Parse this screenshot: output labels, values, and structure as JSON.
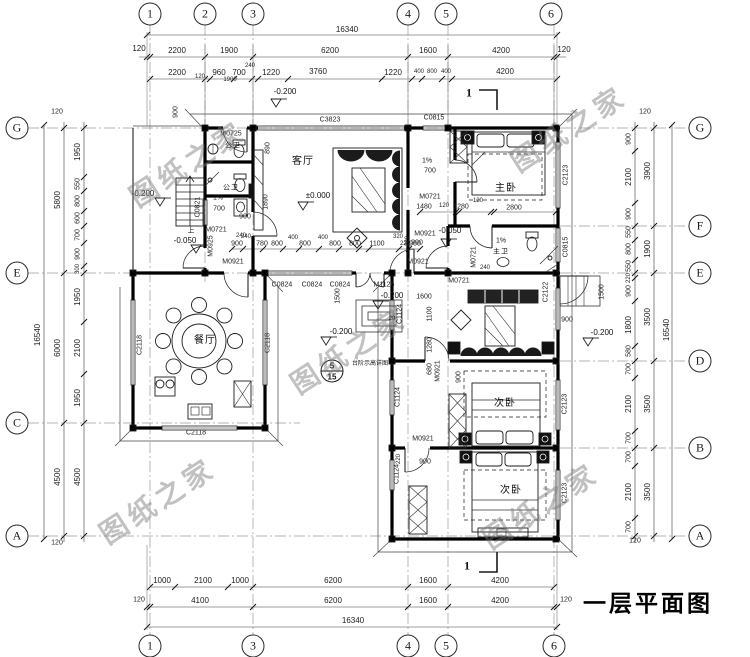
{
  "title": "一层平面图",
  "watermarks": {
    "text": "图纸之家",
    "positions": [
      {
        "x": 187,
        "y": 163
      },
      {
        "x": 568,
        "y": 128
      },
      {
        "x": 348,
        "y": 350
      },
      {
        "x": 540,
        "y": 505
      },
      {
        "x": 157,
        "y": 500
      }
    ]
  },
  "section": {
    "label": "1"
  },
  "detail_ref": {
    "num": "5",
    "sheet": "15",
    "note": "台阶示高详图"
  },
  "axis_markers": {
    "top": [
      {
        "label": "1",
        "x": 150
      },
      {
        "label": "2",
        "x": 205
      },
      {
        "label": "3",
        "x": 253
      },
      {
        "label": "4",
        "x": 408
      },
      {
        "label": "5",
        "x": 446
      },
      {
        "label": "6",
        "x": 551
      }
    ],
    "bottom": [
      {
        "label": "1",
        "x": 150
      },
      {
        "label": "3",
        "x": 253
      },
      {
        "label": "4",
        "x": 408
      },
      {
        "label": "5",
        "x": 446
      },
      {
        "label": "6",
        "x": 554
      }
    ],
    "left": [
      {
        "label": "G",
        "y": 128
      },
      {
        "label": "E",
        "y": 273
      },
      {
        "label": "C",
        "y": 423
      },
      {
        "label": "A",
        "y": 536
      }
    ],
    "right": [
      {
        "label": "G",
        "y": 128
      },
      {
        "label": "F",
        "y": 226
      },
      {
        "label": "E",
        "y": 273
      },
      {
        "label": "D",
        "y": 361
      },
      {
        "label": "B",
        "y": 448
      },
      {
        "label": "A",
        "y": 536
      }
    ]
  },
  "labels": {
    "dims_top": [
      {
        "t": "16340",
        "x": 347,
        "y": 30
      },
      {
        "t": "120",
        "x": 139,
        "y": 49
      },
      {
        "t": "2200",
        "x": 177,
        "y": 51
      },
      {
        "t": "1900",
        "x": 229,
        "y": 51
      },
      {
        "t": "6200",
        "x": 330,
        "y": 51
      },
      {
        "t": "1600",
        "x": 428,
        "y": 51
      },
      {
        "t": "4200",
        "x": 501,
        "y": 51
      },
      {
        "t": "120",
        "x": 564,
        "y": 50
      },
      {
        "t": "2200",
        "x": 177,
        "y": 73
      },
      {
        "t": "120",
        "x": 200,
        "y": 77,
        "s": 6
      },
      {
        "t": "960",
        "x": 219,
        "y": 73
      },
      {
        "t": "700",
        "x": 239,
        "y": 73
      },
      {
        "t": "240",
        "x": 250,
        "y": 66,
        "s": 6
      },
      {
        "t": "1900",
        "x": 230,
        "y": 80,
        "s": 6
      },
      {
        "t": "1220",
        "x": 271,
        "y": 73
      },
      {
        "t": "3760",
        "x": 318,
        "y": 72
      },
      {
        "t": "1220",
        "x": 393,
        "y": 73
      },
      {
        "t": "400",
        "x": 419,
        "y": 72,
        "s": 6
      },
      {
        "t": "800",
        "x": 432,
        "y": 72,
        "s": 6
      },
      {
        "t": "400",
        "x": 446,
        "y": 72,
        "s": 6
      },
      {
        "t": "4200",
        "x": 505,
        "y": 72
      },
      {
        "t": "900",
        "x": 176,
        "y": 112,
        "v": true,
        "s": 7
      }
    ],
    "dims_bottom": [
      {
        "t": "1000",
        "x": 162,
        "y": 581
      },
      {
        "t": "2100",
        "x": 203,
        "y": 581
      },
      {
        "t": "1000",
        "x": 240,
        "y": 581
      },
      {
        "t": "6200",
        "x": 333,
        "y": 581
      },
      {
        "t": "1600",
        "x": 428,
        "y": 581
      },
      {
        "t": "4200",
        "x": 500,
        "y": 581
      },
      {
        "t": "120",
        "x": 139,
        "y": 600,
        "s": 7
      },
      {
        "t": "4100",
        "x": 200,
        "y": 601
      },
      {
        "t": "6200",
        "x": 333,
        "y": 601
      },
      {
        "t": "1600",
        "x": 428,
        "y": 601
      },
      {
        "t": "4200",
        "x": 500,
        "y": 601
      },
      {
        "t": "120",
        "x": 566,
        "y": 600,
        "s": 7
      },
      {
        "t": "16340",
        "x": 353,
        "y": 621
      }
    ],
    "dims_left": [
      {
        "t": "1950",
        "x": 78,
        "y": 152,
        "v": true
      },
      {
        "t": "550",
        "x": 78,
        "y": 184,
        "v": true,
        "s": 7
      },
      {
        "t": "800",
        "x": 78,
        "y": 201,
        "v": true,
        "s": 7
      },
      {
        "t": "600",
        "x": 78,
        "y": 218,
        "v": true,
        "s": 7
      },
      {
        "t": "700",
        "x": 78,
        "y": 235,
        "v": true,
        "s": 7
      },
      {
        "t": "900",
        "x": 78,
        "y": 254,
        "v": true,
        "s": 7
      },
      {
        "t": "300",
        "x": 78,
        "y": 269,
        "v": true,
        "s": 6
      },
      {
        "t": "1950",
        "x": 78,
        "y": 297,
        "v": true
      },
      {
        "t": "2100",
        "x": 78,
        "y": 348,
        "v": true
      },
      {
        "t": "1950",
        "x": 78,
        "y": 398,
        "v": true
      },
      {
        "t": "4500",
        "x": 78,
        "y": 477,
        "v": true
      },
      {
        "t": "5800",
        "x": 58,
        "y": 200,
        "v": true
      },
      {
        "t": "6000",
        "x": 58,
        "y": 348,
        "v": true
      },
      {
        "t": "4500",
        "x": 58,
        "y": 477,
        "v": true
      },
      {
        "t": "16540",
        "x": 38,
        "y": 335,
        "v": true
      },
      {
        "t": "120",
        "x": 57,
        "y": 112,
        "s": 7
      },
      {
        "t": "120",
        "x": 57,
        "y": 543,
        "s": 7
      }
    ],
    "dims_right": [
      {
        "t": "900",
        "x": 629,
        "y": 139,
        "v": true,
        "s": 7
      },
      {
        "t": "2100",
        "x": 629,
        "y": 177,
        "v": true
      },
      {
        "t": "900",
        "x": 629,
        "y": 214,
        "v": true,
        "s": 7
      },
      {
        "t": "550",
        "x": 629,
        "y": 232,
        "v": true,
        "s": 7
      },
      {
        "t": "800",
        "x": 629,
        "y": 249,
        "v": true,
        "s": 7
      },
      {
        "t": "550",
        "x": 629,
        "y": 266,
        "v": true,
        "s": 7
      },
      {
        "t": "220",
        "x": 629,
        "y": 278,
        "v": true,
        "s": 6
      },
      {
        "t": "900",
        "x": 629,
        "y": 291,
        "v": true,
        "s": 7
      },
      {
        "t": "1800",
        "x": 629,
        "y": 325,
        "v": true
      },
      {
        "t": "580",
        "x": 629,
        "y": 351,
        "v": true,
        "s": 7
      },
      {
        "t": "700",
        "x": 629,
        "y": 369,
        "v": true,
        "s": 7
      },
      {
        "t": "2100",
        "x": 629,
        "y": 404,
        "v": true
      },
      {
        "t": "700",
        "x": 629,
        "y": 438,
        "v": true,
        "s": 7
      },
      {
        "t": "700",
        "x": 629,
        "y": 457,
        "v": true,
        "s": 7
      },
      {
        "t": "2100",
        "x": 629,
        "y": 492,
        "v": true
      },
      {
        "t": "700",
        "x": 629,
        "y": 527,
        "v": true,
        "s": 7
      },
      {
        "t": "3900",
        "x": 648,
        "y": 171,
        "v": true
      },
      {
        "t": "1900",
        "x": 648,
        "y": 249,
        "v": true
      },
      {
        "t": "3500",
        "x": 648,
        "y": 317,
        "v": true
      },
      {
        "t": "3500",
        "x": 648,
        "y": 404,
        "v": true
      },
      {
        "t": "3500",
        "x": 648,
        "y": 492,
        "v": true
      },
      {
        "t": "16540",
        "x": 667,
        "y": 330,
        "v": true
      },
      {
        "t": "120",
        "x": 645,
        "y": 112,
        "s": 7
      },
      {
        "t": "120",
        "x": 635,
        "y": 541,
        "s": 7
      },
      {
        "t": "1500",
        "x": 602,
        "y": 292,
        "v": true,
        "s": 7
      },
      {
        "t": "900",
        "x": 567,
        "y": 320,
        "s": 7
      }
    ],
    "dims_interior": [
      {
        "t": "240",
        "x": 246,
        "y": 237,
        "s": 6
      },
      {
        "t": "900",
        "x": 237,
        "y": 244,
        "s": 7
      },
      {
        "t": "780",
        "x": 262,
        "y": 244,
        "s": 7
      },
      {
        "t": "800",
        "x": 277,
        "y": 244,
        "s": 7
      },
      {
        "t": "400",
        "x": 293,
        "y": 238,
        "s": 6
      },
      {
        "t": "800",
        "x": 305,
        "y": 244,
        "s": 7
      },
      {
        "t": "400",
        "x": 323,
        "y": 238,
        "s": 6
      },
      {
        "t": "800",
        "x": 335,
        "y": 244,
        "s": 7
      },
      {
        "t": "800",
        "x": 355,
        "y": 244,
        "s": 7
      },
      {
        "t": "1100",
        "x": 377,
        "y": 244,
        "s": 7
      },
      {
        "t": "320",
        "x": 398,
        "y": 237,
        "s": 6
      },
      {
        "t": "220",
        "x": 405,
        "y": 244,
        "s": 6
      },
      {
        "t": "900",
        "x": 415,
        "y": 244,
        "s": 7
      },
      {
        "t": "1480",
        "x": 424,
        "y": 207,
        "s": 7
      },
      {
        "t": "120",
        "x": 444,
        "y": 206,
        "s": 6
      },
      {
        "t": "1280",
        "x": 461,
        "y": 207,
        "s": 7
      },
      {
        "t": "120",
        "x": 478,
        "y": 201,
        "s": 6
      },
      {
        "t": "2800",
        "x": 514,
        "y": 208,
        "s": 7
      },
      {
        "t": "700",
        "x": 219,
        "y": 209,
        "s": 7
      },
      {
        "t": "900",
        "x": 245,
        "y": 217,
        "s": 7
      },
      {
        "t": "240",
        "x": 241,
        "y": 236,
        "s": 6
      },
      {
        "t": "890",
        "x": 268,
        "y": 148,
        "v": true,
        "s": 7
      },
      {
        "t": "1890",
        "x": 266,
        "y": 202,
        "v": true,
        "s": 7
      },
      {
        "t": "1%",
        "x": 218,
        "y": 198,
        "s": 7
      },
      {
        "t": "1%",
        "x": 427,
        "y": 161,
        "s": 7
      },
      {
        "t": "700",
        "x": 430,
        "y": 171,
        "s": 7
      },
      {
        "t": "1%",
        "x": 501,
        "y": 241,
        "s": 7
      },
      {
        "t": "220",
        "x": 408,
        "y": 241,
        "v": true,
        "s": 6
      },
      {
        "t": "900",
        "x": 417,
        "y": 243,
        "s": 7
      },
      {
        "t": "240",
        "x": 485,
        "y": 268,
        "s": 6
      },
      {
        "t": "1600",
        "x": 424,
        "y": 297,
        "s": 7
      },
      {
        "t": "20",
        "x": 392,
        "y": 319,
        "s": 6
      },
      {
        "t": "1100",
        "x": 430,
        "y": 314,
        "v": true,
        "s": 7
      },
      {
        "t": "1280",
        "x": 430,
        "y": 345,
        "v": true,
        "s": 7
      },
      {
        "t": "680",
        "x": 430,
        "y": 369,
        "v": true,
        "s": 7
      },
      {
        "t": "900",
        "x": 459,
        "y": 377,
        "v": true,
        "s": 7
      },
      {
        "t": "900",
        "x": 425,
        "y": 462,
        "s": 7
      },
      {
        "t": "220",
        "x": 399,
        "y": 459,
        "v": true,
        "s": 6
      },
      {
        "t": "1500",
        "x": 338,
        "y": 296,
        "v": true,
        "s": 7
      }
    ],
    "openings": [
      {
        "t": "C3823",
        "x": 330,
        "y": 120
      },
      {
        "t": "C0815",
        "x": 434,
        "y": 118
      },
      {
        "t": "C2123",
        "x": 566,
        "y": 175,
        "v": true
      },
      {
        "t": "C0815",
        "x": 566,
        "y": 247,
        "v": true
      },
      {
        "t": "C2122",
        "x": 546,
        "y": 292,
        "v": true
      },
      {
        "t": "C2123",
        "x": 565,
        "y": 404,
        "v": true
      },
      {
        "t": "C2123",
        "x": 565,
        "y": 493,
        "v": true
      },
      {
        "t": "C1124",
        "x": 400,
        "y": 314,
        "v": true
      },
      {
        "t": "C1124",
        "x": 398,
        "y": 397,
        "v": true
      },
      {
        "t": "C1124",
        "x": 397,
        "y": 474,
        "v": true
      },
      {
        "t": "C2118",
        "x": 140,
        "y": 345,
        "v": true
      },
      {
        "t": "C2118",
        "x": 268,
        "y": 343,
        "v": true
      },
      {
        "t": "C2118",
        "x": 196,
        "y": 433
      },
      {
        "t": "C0824",
        "x": 282,
        "y": 285
      },
      {
        "t": "C0824",
        "x": 312,
        "y": 285
      },
      {
        "t": "C0824",
        "x": 340,
        "y": 285
      },
      {
        "t": "M1126",
        "x": 384,
        "y": 285
      },
      {
        "t": "C0821",
        "x": 198,
        "y": 207,
        "v": true
      },
      {
        "t": "M0725",
        "x": 231,
        "y": 134
      },
      {
        "t": "M0721",
        "x": 216,
        "y": 230
      },
      {
        "t": "M0925",
        "x": 211,
        "y": 246,
        "v": true
      },
      {
        "t": "M0921",
        "x": 233,
        "y": 262
      },
      {
        "t": "M0921",
        "x": 418,
        "y": 262
      },
      {
        "t": "M0721",
        "x": 430,
        "y": 197
      },
      {
        "t": "M0921",
        "x": 425,
        "y": 234
      },
      {
        "t": "M0721",
        "x": 474,
        "y": 257,
        "v": true
      },
      {
        "t": "M0721",
        "x": 459,
        "y": 281
      },
      {
        "t": "M0921",
        "x": 438,
        "y": 371,
        "v": true
      },
      {
        "t": "M0921",
        "x": 423,
        "y": 439
      }
    ],
    "rooms": [
      {
        "t": "客厅",
        "x": 303,
        "y": 162
      },
      {
        "t": "主卧",
        "x": 506,
        "y": 189
      },
      {
        "t": "餐厅",
        "x": 205,
        "y": 341
      },
      {
        "t": "次卧",
        "x": 505,
        "y": 404
      },
      {
        "t": "次卧",
        "x": 511,
        "y": 491
      },
      {
        "t": "公卫",
        "x": 233,
        "y": 146,
        "s": 7
      },
      {
        "t": "公卫",
        "x": 231,
        "y": 188,
        "s": 7
      },
      {
        "t": "主卫",
        "x": 501,
        "y": 252,
        "s": 7
      }
    ],
    "levels": [
      {
        "t": "±0.000",
        "x": 318,
        "y": 196
      },
      {
        "t": "-0.200",
        "x": 285,
        "y": 92
      },
      {
        "t": "-0.200",
        "x": 143,
        "y": 194
      },
      {
        "t": "-0.050",
        "x": 185,
        "y": 241
      },
      {
        "t": "-0.050",
        "x": 450,
        "y": 231
      },
      {
        "t": "-0.200",
        "x": 341,
        "y": 332
      },
      {
        "t": "-0.200",
        "x": 602,
        "y": 333
      },
      {
        "t": "-0.200",
        "x": 392,
        "y": 296
      }
    ],
    "notes": [
      {
        "t": "上",
        "x": 191,
        "y": 231
      },
      {
        "t": "台阶示高详图",
        "x": 370,
        "y": 364,
        "s": 6
      }
    ]
  }
}
